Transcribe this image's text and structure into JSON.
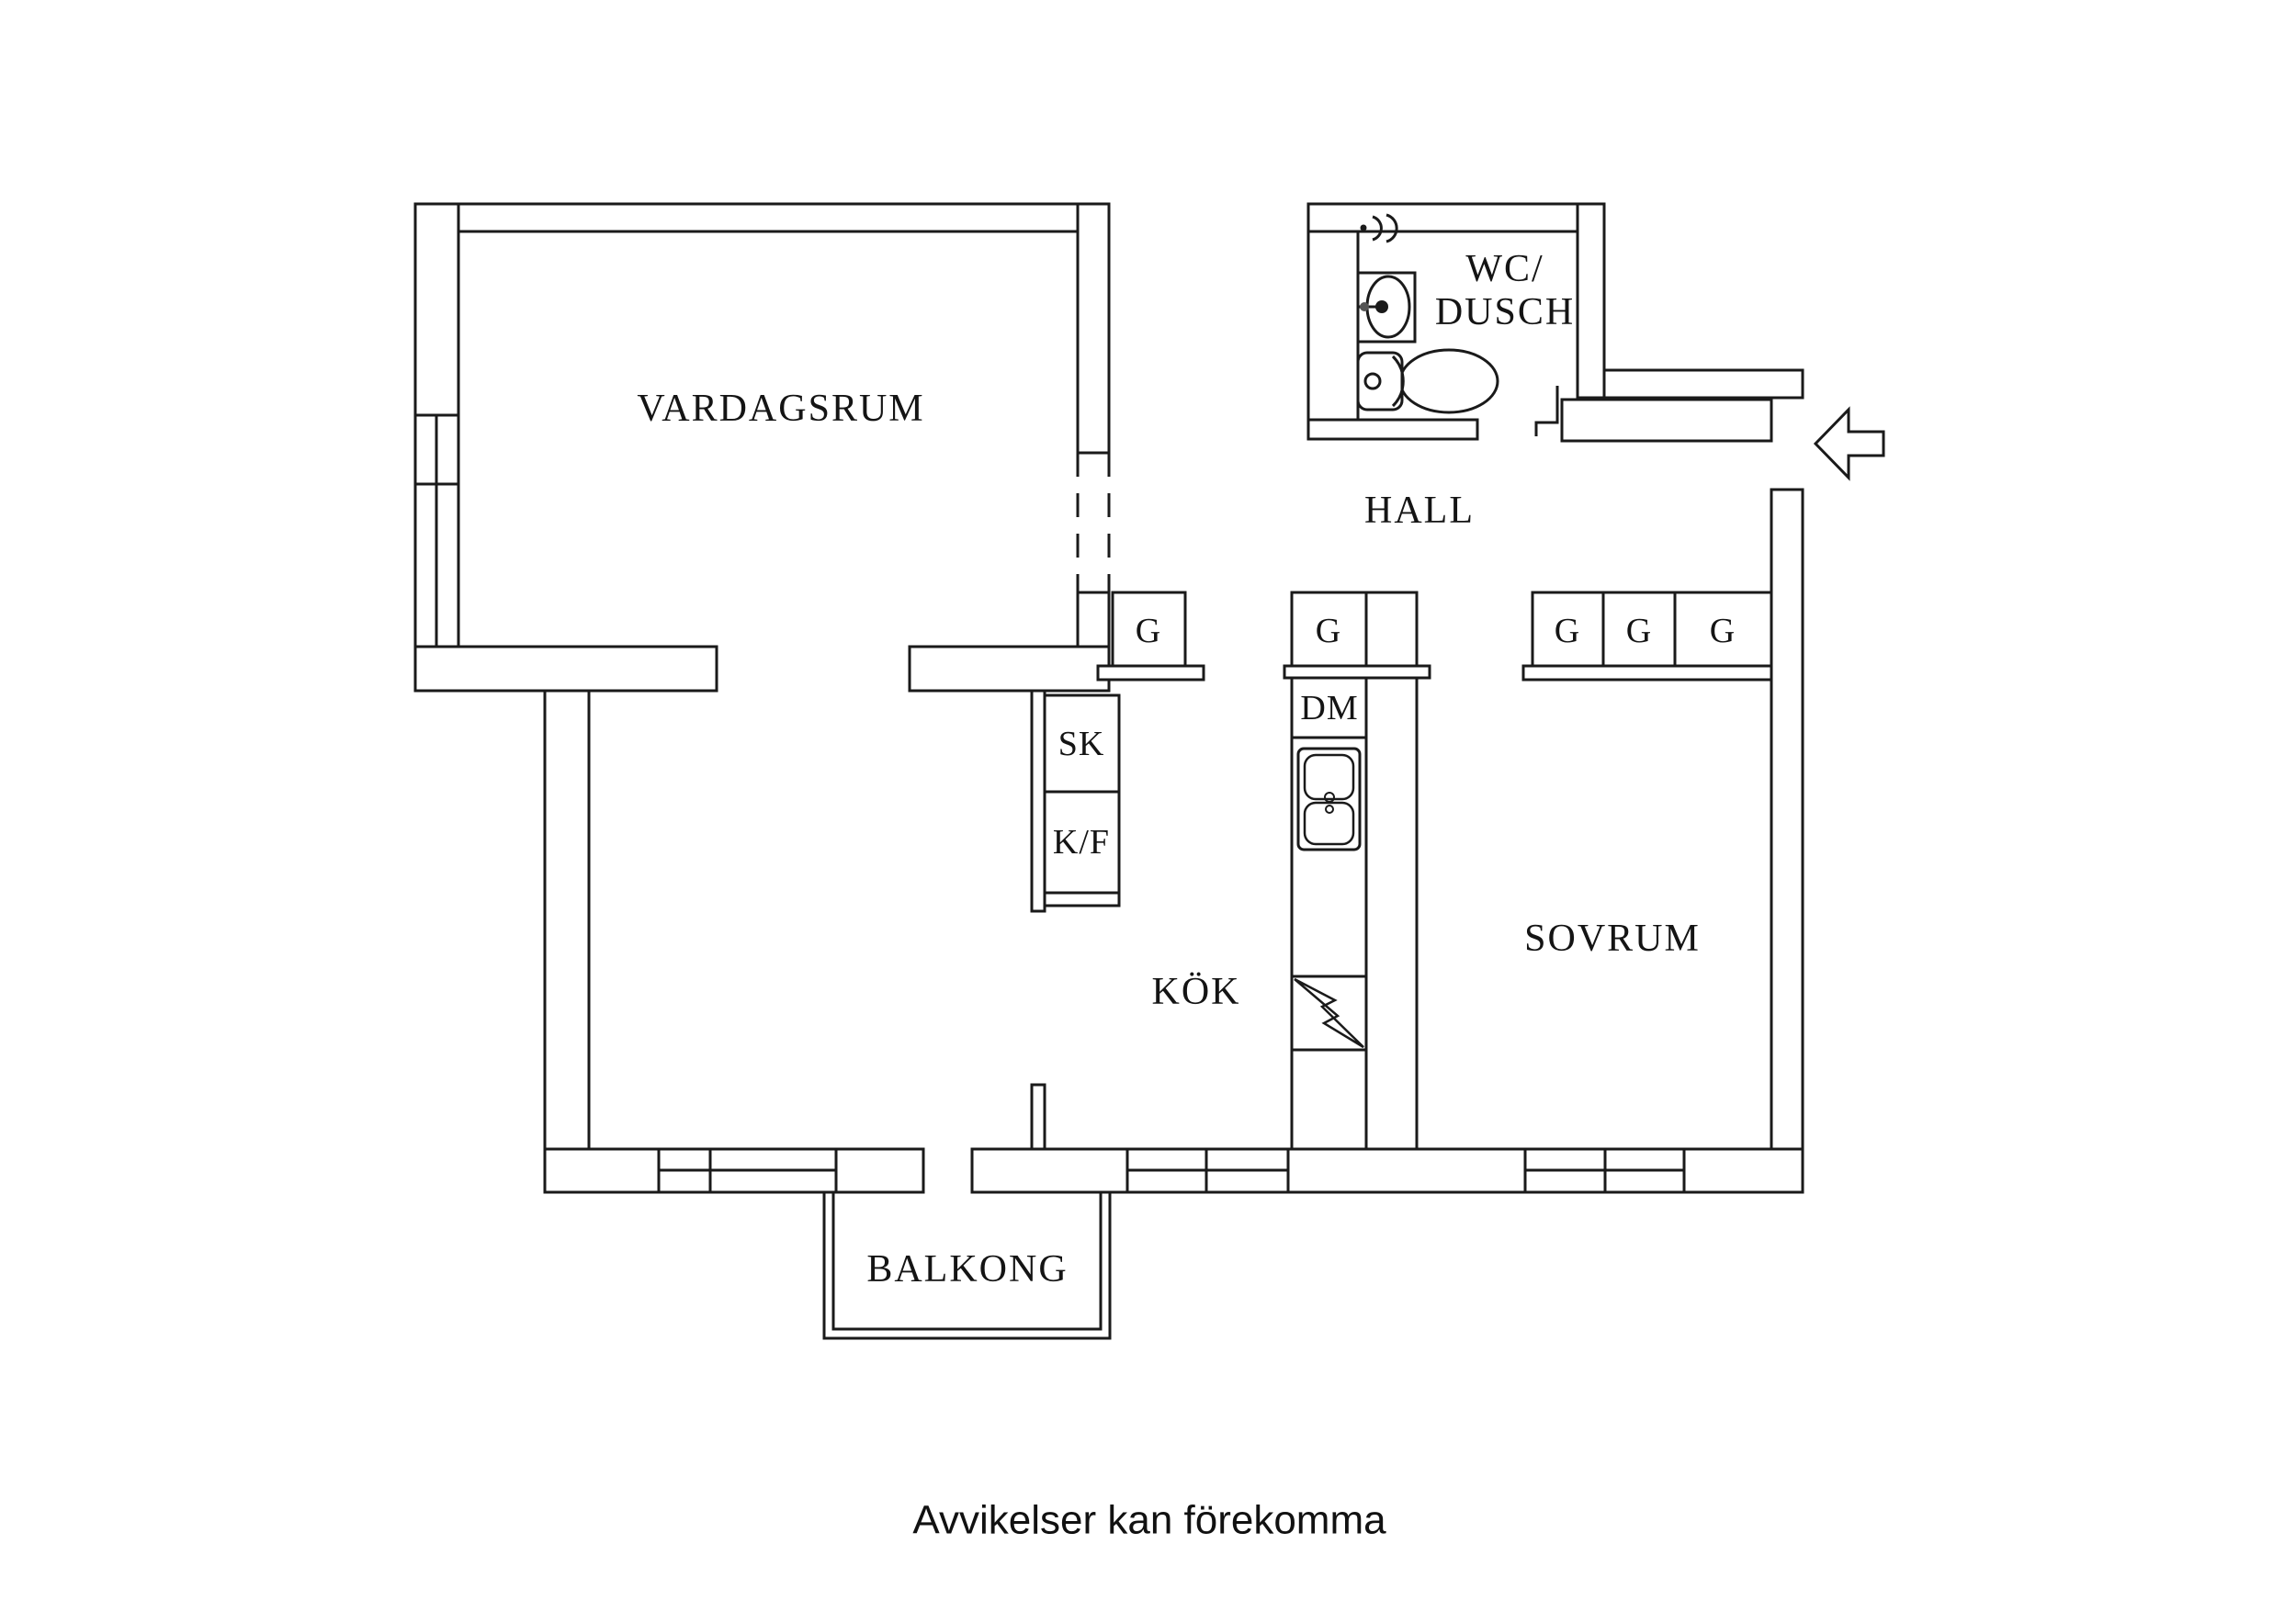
{
  "plan": {
    "background_color": "#ffffff",
    "line_color": "#1a1a1a",
    "text_color": "#141414",
    "rooms": {
      "vardagsrum": "VARDAGSRUM",
      "wc_dusch_line1": "WC/",
      "wc_dusch_line2": "DUSCH",
      "hall": "HALL",
      "kok": "KÖK",
      "sovrum": "SOVRUM",
      "balkong": "BALKONG"
    },
    "fixtures": {
      "hall_wardrobe": "G",
      "kitchen_wardrobe": "G",
      "bedroom_wardrobes": [
        "G",
        "G",
        "G"
      ],
      "cleaning_cabinet": "SK",
      "fridge_freezer": "K/F",
      "dishwasher": "DM"
    },
    "icons": [
      "entry-arrow-icon",
      "shower-icon",
      "washbasin-icon",
      "toilet-icon",
      "kitchen-sink-icon",
      "stove-lightning-icon"
    ],
    "note": "Avvikelser kan förekomma"
  }
}
